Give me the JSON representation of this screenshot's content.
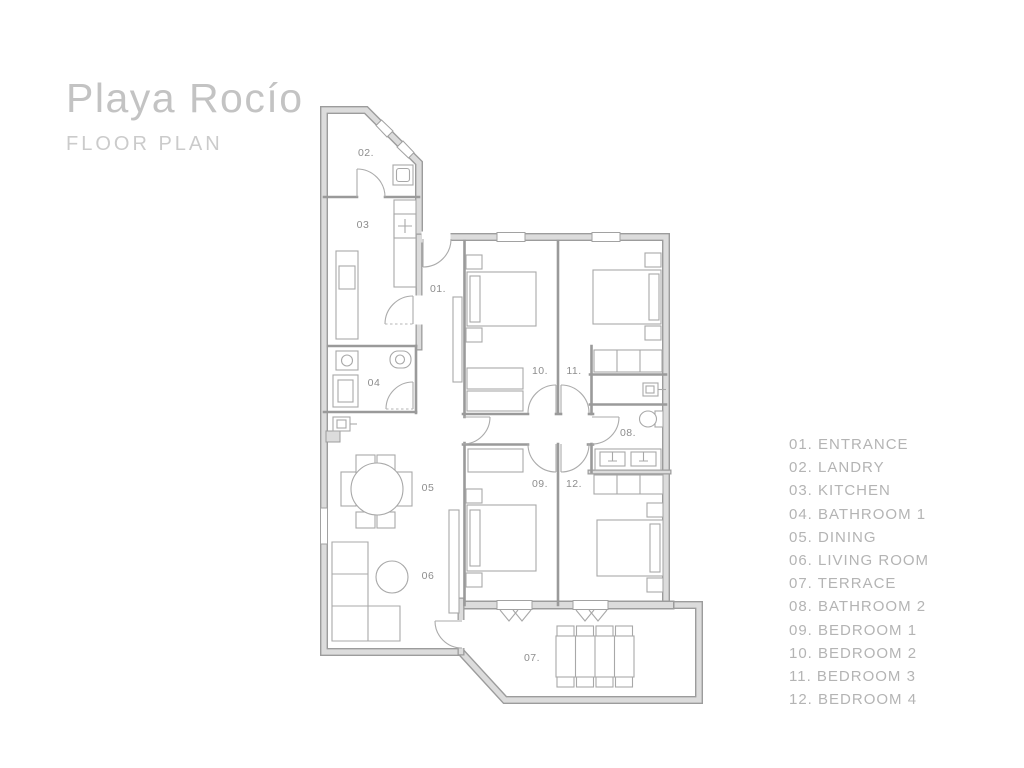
{
  "header": {
    "title": "Playa Rocío",
    "subtitle": "FLOOR PLAN"
  },
  "legend": {
    "items": [
      "01. ENTRANCE",
      "02. LANDRY",
      "03. KITCHEN",
      "04. BATHROOM 1",
      "05. DINING",
      "06. LIVING ROOM",
      "07. TERRACE",
      "08. BATHROOM 2",
      "09. BEDROOM 1",
      "10. BEDROOM 2",
      "11. BEDROOM 3",
      "12. BEDROOM 4"
    ]
  },
  "plan": {
    "room_labels": [
      {
        "room": "entrance",
        "text": "01."
      },
      {
        "room": "laundry",
        "text": "02."
      },
      {
        "room": "kitchen",
        "text": "03"
      },
      {
        "room": "bathroom-1",
        "text": "04"
      },
      {
        "room": "dining",
        "text": "05"
      },
      {
        "room": "living-room",
        "text": "06"
      },
      {
        "room": "terrace",
        "text": "07."
      },
      {
        "room": "bathroom-2",
        "text": "08."
      },
      {
        "room": "bedroom-1",
        "text": "09."
      },
      {
        "room": "bedroom-2",
        "text": "10."
      },
      {
        "room": "bedroom-3",
        "text": "11."
      },
      {
        "room": "bedroom-4",
        "text": "12."
      }
    ]
  },
  "colors": {
    "background": "#ffffff",
    "wall_fill": "#dcdcdc",
    "wall_edge": "#9c9c9c",
    "furniture_line": "#a8a8a8",
    "room_label": "#8d8d8d",
    "title": "#c3c3c3",
    "subtitle": "#cbcbcb",
    "legend_text": "#b4b4b4"
  }
}
